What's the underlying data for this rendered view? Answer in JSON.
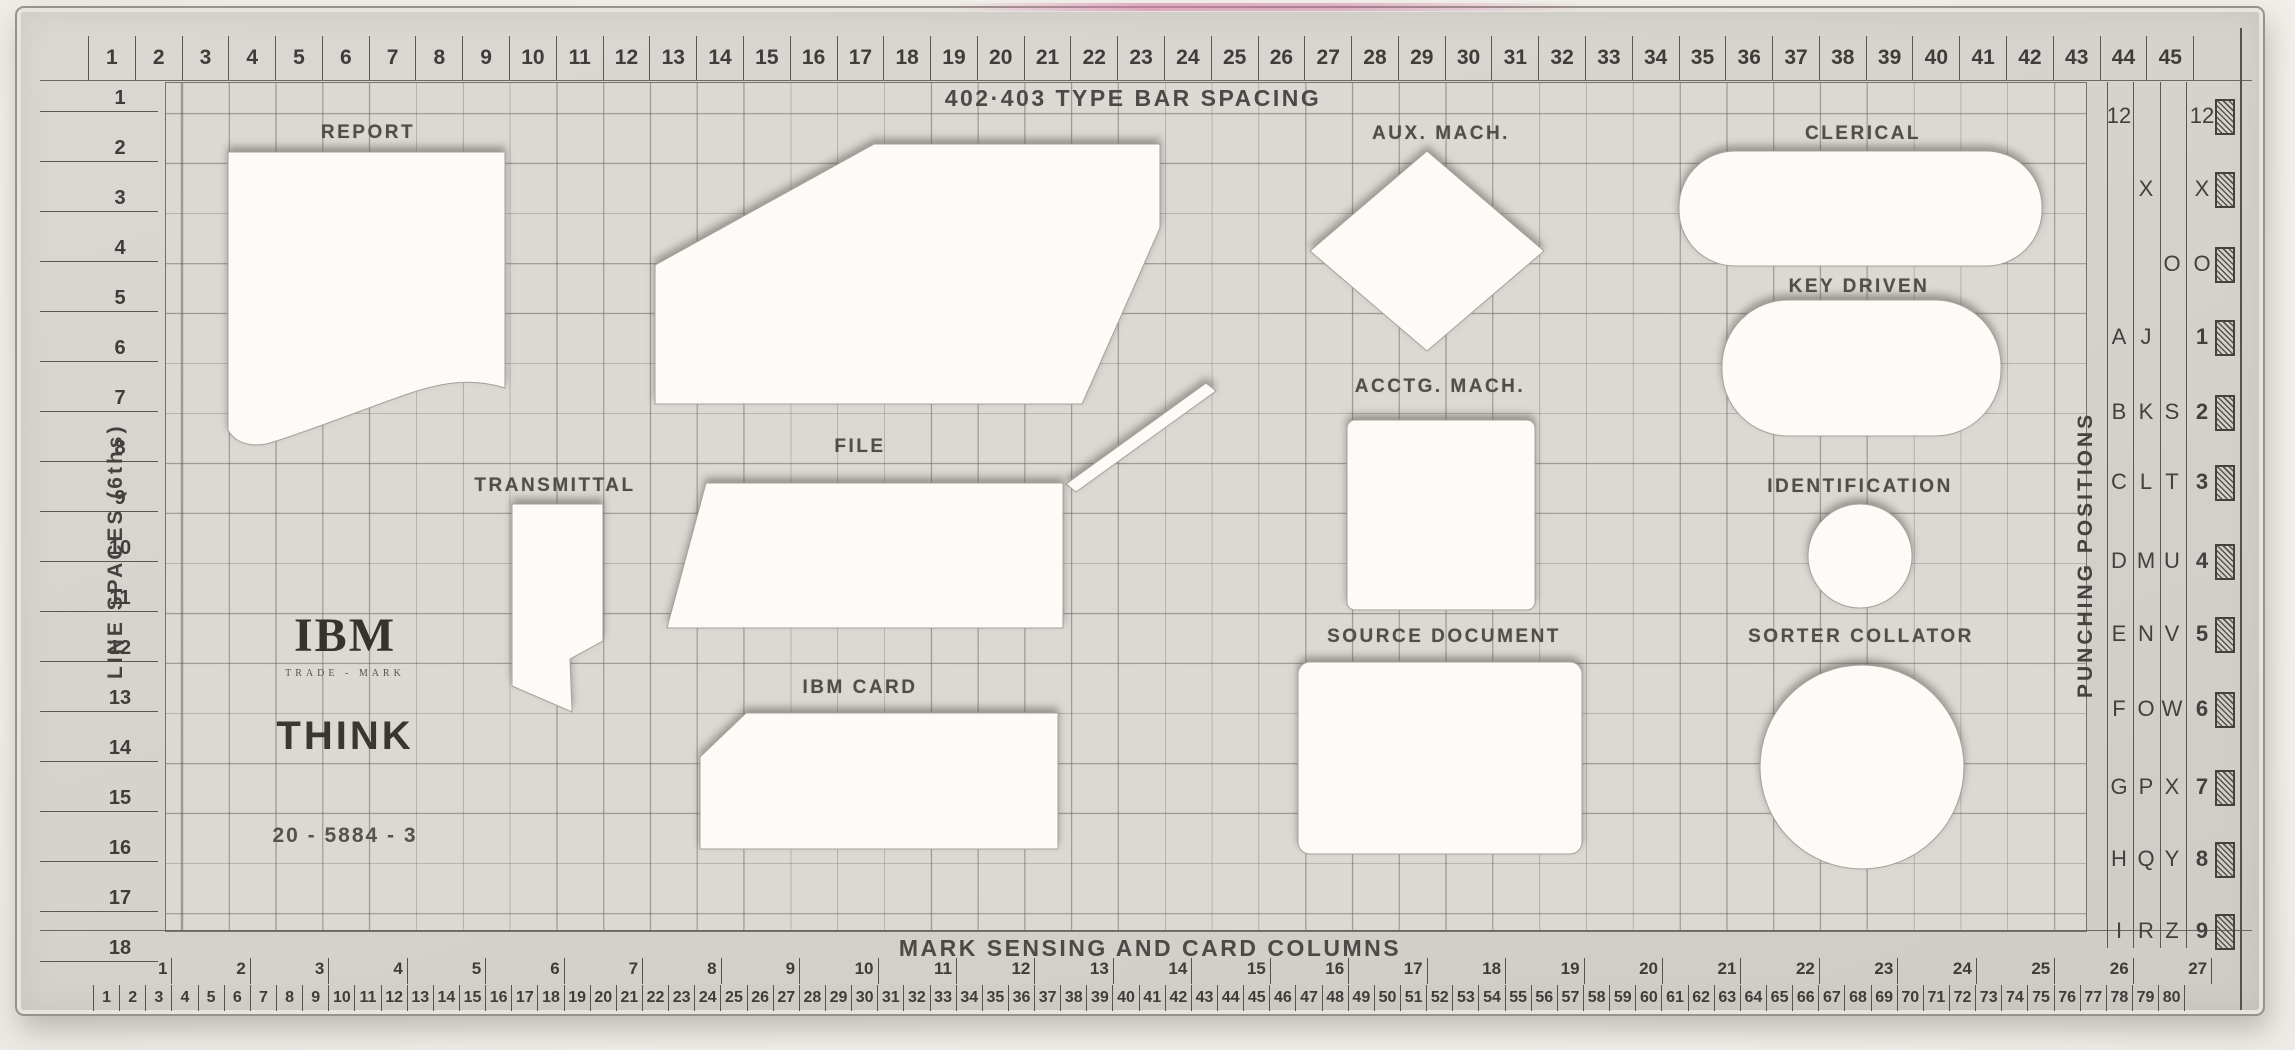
{
  "template": {
    "top_ruler": {
      "title": "402·403 TYPE BAR SPACING",
      "units": [
        1,
        2,
        3,
        4,
        5,
        6,
        7,
        8,
        9,
        10,
        11,
        12,
        13,
        14,
        15,
        16,
        17,
        18,
        19,
        20,
        21,
        22,
        23,
        24,
        25,
        26,
        27,
        28,
        29,
        30,
        31,
        32,
        33,
        34,
        35,
        36,
        37,
        38,
        39,
        40,
        41,
        42,
        43,
        44,
        45
      ]
    },
    "left_ruler": {
      "label": "LINE SPACES (6ths)",
      "units": [
        1,
        2,
        3,
        4,
        5,
        6,
        7,
        8,
        9,
        10,
        11,
        12,
        13,
        14,
        15,
        16,
        17,
        18
      ]
    },
    "right_panel": {
      "label": "PUNCHING POSITIONS",
      "rows": [
        {
          "cells": [
            "12",
            "",
            "",
            "12"
          ]
        },
        {
          "cells": [
            "",
            "X",
            "",
            "X"
          ]
        },
        {
          "cells": [
            "",
            "",
            "O",
            "O"
          ]
        },
        {
          "cells": [
            "A",
            "J",
            "",
            "1"
          ]
        },
        {
          "cells": [
            "B",
            "K",
            "S",
            "2"
          ]
        },
        {
          "cells": [
            "C",
            "L",
            "T",
            "3"
          ]
        },
        {
          "cells": [
            "D",
            "M",
            "U",
            "4"
          ]
        },
        {
          "cells": [
            "E",
            "N",
            "V",
            "5"
          ]
        },
        {
          "cells": [
            "F",
            "O",
            "W",
            "6"
          ]
        },
        {
          "cells": [
            "G",
            "P",
            "X",
            "7"
          ]
        },
        {
          "cells": [
            "H",
            "Q",
            "Y",
            "8"
          ]
        },
        {
          "cells": [
            "I",
            "R",
            "Z",
            "9"
          ]
        }
      ]
    },
    "bottom_ruler": {
      "title": "MARK SENSING AND CARD COLUMNS",
      "groups": [
        1,
        2,
        3,
        4,
        5,
        6,
        7,
        8,
        9,
        10,
        11,
        12,
        13,
        14,
        15,
        16,
        17,
        18,
        19,
        20,
        21,
        22,
        23,
        24,
        25,
        26,
        27
      ],
      "columns": [
        1,
        2,
        3,
        4,
        5,
        6,
        7,
        8,
        9,
        10,
        11,
        12,
        13,
        14,
        15,
        16,
        17,
        18,
        19,
        20,
        21,
        22,
        23,
        24,
        25,
        26,
        27,
        28,
        29,
        30,
        31,
        32,
        33,
        34,
        35,
        36,
        37,
        38,
        39,
        40,
        41,
        42,
        43,
        44,
        45,
        46,
        47,
        48,
        49,
        50,
        51,
        52,
        53,
        54,
        55,
        56,
        57,
        58,
        59,
        60,
        61,
        62,
        63,
        64,
        65,
        66,
        67,
        68,
        69,
        70,
        71,
        72,
        73,
        74,
        75,
        76,
        77,
        78,
        79,
        80
      ]
    },
    "shape_labels": {
      "report": "REPORT",
      "transmittal": "TRANSMITTAL",
      "file": "FILE",
      "ibm_card": "IBM CARD",
      "aux_mach": "AUX. MACH.",
      "acctg_mach": "ACCTG. MACH.",
      "source_document": "SOURCE DOCUMENT",
      "clerical": "CLERICAL",
      "key_driven": "KEY DRIVEN",
      "identification": "IDENTIFICATION",
      "sorter_collator": "SORTER COLLATOR"
    },
    "branding": {
      "logo": "IBM",
      "trademark": "TRADE - MARK",
      "slogan": "THINK",
      "part_number": "20 - 5884 - 3"
    },
    "colors": {
      "plastic": "#d5d2cc",
      "grid_area": "#dcd9d4",
      "cutout": "#fcfbf8",
      "ink": "#3f3d3a",
      "photo_background": "#f2f0ea",
      "pink_smear": "#d678a6"
    }
  }
}
